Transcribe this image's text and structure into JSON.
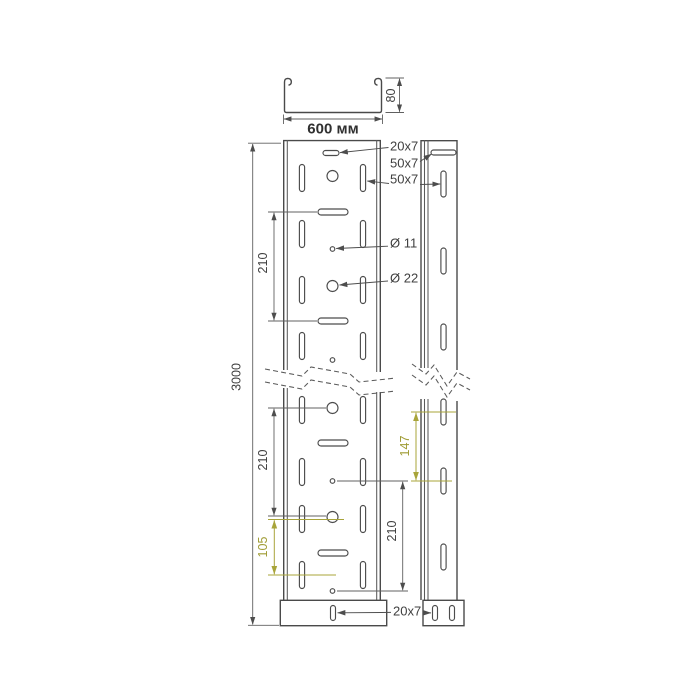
{
  "colors": {
    "line": "#4a4a4a",
    "dimension": "#606060",
    "accent": "#a8a43a",
    "background": "#ffffff"
  },
  "section_view": {
    "width": "600 мм",
    "height": "80"
  },
  "plan_view": {
    "length": "3000",
    "hole_pitch_upper": "210",
    "hole_pitch_lower": "210",
    "hole_pitch_right": "210",
    "end_offset": "105"
  },
  "side_view": {
    "slot_pitch": "147"
  },
  "callouts": {
    "top_slot": "20x7",
    "rail_slot": "50x7",
    "wall_slot": "50x7",
    "small_hole": "Ø 11",
    "large_hole": "Ø 22",
    "bottom_slot": "20x7"
  }
}
